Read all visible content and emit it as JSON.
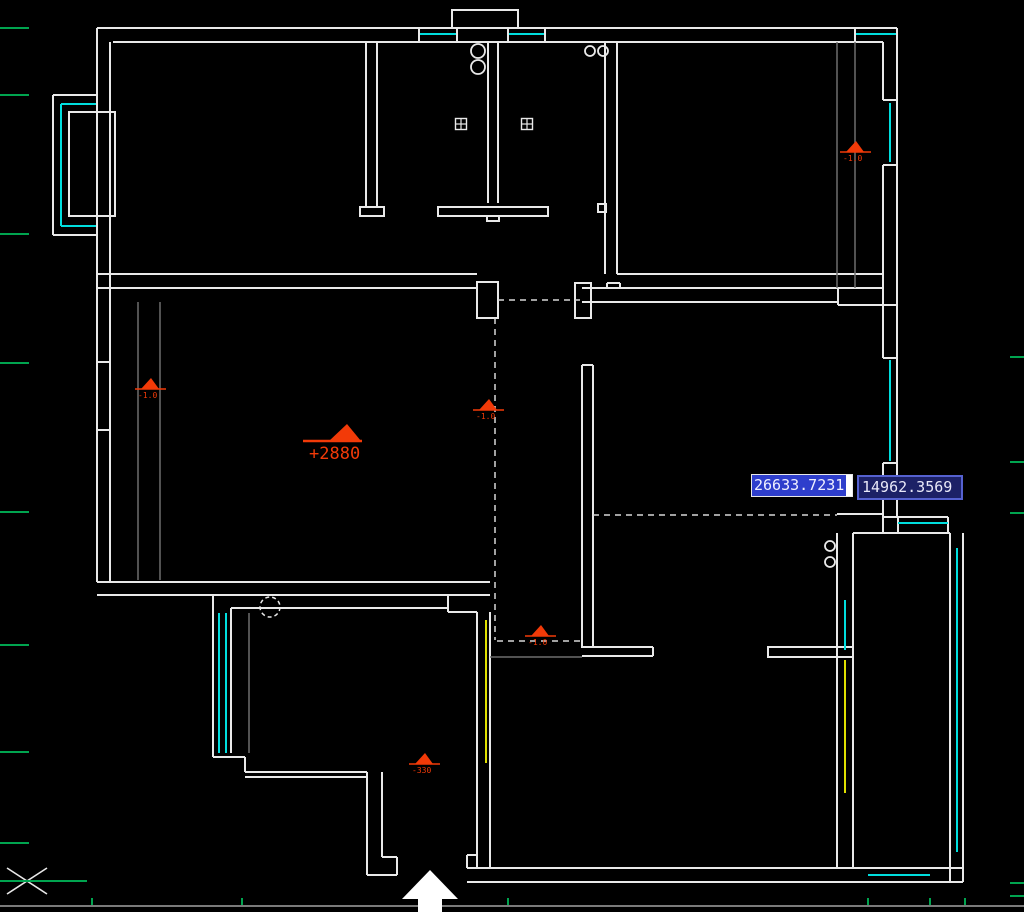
{
  "app": {
    "name": "cad-drawing-canvas",
    "background": "#000000",
    "edge_line_color": "#7a7a7a"
  },
  "dynamic_input": {
    "x_value": "26633.7231",
    "y_value": "14962.3569",
    "x_selected": true,
    "highlight_color": "#2e3ecc",
    "box2_bg": "#1c2166",
    "box2_border": "#5561d0"
  },
  "labels": {
    "main_elevation": "+2880"
  },
  "colors": {
    "wall": "#e9e9e9",
    "gray": "#6e6e6e",
    "window": "#00dede",
    "door": "#e0e000",
    "marker": "#f23a08",
    "green": "#00a44f",
    "dashed": "#d8d8d8",
    "arrow": "#ffffff"
  },
  "geometry": {
    "solid_lines": [
      [
        97,
        28,
        897,
        28
      ],
      [
        113,
        42,
        883,
        42
      ],
      [
        97,
        28,
        97,
        582
      ],
      [
        110,
        42,
        110,
        582
      ],
      [
        53,
        95,
        97,
        95
      ],
      [
        53,
        95,
        53,
        235
      ],
      [
        53,
        235,
        97,
        235
      ],
      [
        97,
        274,
        477,
        274
      ],
      [
        97,
        288,
        477,
        288
      ],
      [
        366,
        42,
        366,
        207
      ],
      [
        377,
        42,
        377,
        207
      ],
      [
        488,
        42,
        488,
        203
      ],
      [
        498,
        42,
        498,
        203
      ],
      [
        605,
        42,
        605,
        274
      ],
      [
        617,
        42,
        617,
        274
      ],
      [
        617,
        274,
        883,
        274
      ],
      [
        617,
        288,
        883,
        288
      ],
      [
        582,
        288,
        838,
        288
      ],
      [
        582,
        302,
        838,
        302
      ],
      [
        607,
        283,
        620,
        283
      ],
      [
        607,
        283,
        607,
        288
      ],
      [
        620,
        283,
        620,
        288
      ],
      [
        838,
        288,
        838,
        305
      ],
      [
        838,
        305,
        897,
        305
      ],
      [
        897,
        28,
        897,
        517
      ],
      [
        883,
        42,
        883,
        100
      ],
      [
        883,
        165,
        883,
        358
      ],
      [
        883,
        463,
        883,
        517
      ],
      [
        419,
        28,
        419,
        42
      ],
      [
        457,
        28,
        457,
        42
      ],
      [
        508,
        28,
        508,
        42
      ],
      [
        545,
        28,
        545,
        42
      ],
      [
        855,
        28,
        855,
        42
      ],
      [
        883,
        100,
        897,
        100
      ],
      [
        883,
        165,
        897,
        165
      ],
      [
        883,
        358,
        897,
        358
      ],
      [
        883,
        463,
        897,
        463
      ],
      [
        582,
        365,
        582,
        648
      ],
      [
        593,
        365,
        593,
        648
      ],
      [
        582,
        365,
        593,
        365
      ],
      [
        582,
        647,
        653,
        647
      ],
      [
        582,
        656,
        653,
        656
      ],
      [
        653,
        647,
        653,
        656
      ],
      [
        837,
        514,
        883,
        514
      ],
      [
        883,
        514,
        883,
        533
      ],
      [
        853,
        533,
        950,
        533
      ],
      [
        883,
        517,
        948,
        517
      ],
      [
        898,
        517,
        898,
        533
      ],
      [
        948,
        517,
        948,
        533
      ],
      [
        837,
        533,
        837,
        868
      ],
      [
        853,
        533,
        853,
        868
      ],
      [
        950,
        533,
        950,
        882
      ],
      [
        963,
        533,
        963,
        882
      ],
      [
        837,
        868,
        963,
        868
      ],
      [
        837,
        882,
        963,
        882
      ],
      [
        467,
        868,
        837,
        868
      ],
      [
        467,
        882,
        837,
        882
      ],
      [
        467,
        855,
        467,
        868
      ],
      [
        467,
        855,
        477,
        855
      ],
      [
        477,
        612,
        477,
        868
      ],
      [
        490,
        612,
        490,
        868
      ],
      [
        97,
        582,
        490,
        582
      ],
      [
        97,
        595,
        490,
        595
      ],
      [
        213,
        595,
        213,
        757
      ],
      [
        231,
        608,
        231,
        753
      ],
      [
        213,
        595,
        448,
        595
      ],
      [
        231,
        608,
        448,
        608
      ],
      [
        448,
        595,
        448,
        612
      ],
      [
        448,
        612,
        477,
        612
      ],
      [
        213,
        757,
        245,
        757
      ],
      [
        245,
        757,
        245,
        772
      ],
      [
        245,
        772,
        367,
        772
      ],
      [
        245,
        777,
        367,
        777
      ],
      [
        367,
        772,
        367,
        875
      ],
      [
        382,
        772,
        382,
        857
      ],
      [
        382,
        857,
        397,
        857
      ],
      [
        397,
        857,
        397,
        875
      ],
      [
        367,
        875,
        397,
        875
      ],
      [
        97,
        362,
        110,
        362
      ],
      [
        97,
        430,
        110,
        430
      ]
    ],
    "rects": [
      [
        69,
        112,
        46,
        104
      ],
      [
        477,
        282,
        21,
        36
      ],
      [
        575,
        283,
        16,
        35
      ],
      [
        438,
        207,
        110,
        9
      ],
      [
        487,
        216,
        12,
        5
      ],
      [
        360,
        207,
        24,
        9
      ],
      [
        598,
        204,
        8,
        8
      ],
      [
        768,
        647,
        85,
        10
      ],
      [
        452,
        10,
        66,
        18
      ]
    ],
    "gray_lines": [
      [
        138,
        302,
        138,
        580
      ],
      [
        160,
        302,
        160,
        580
      ],
      [
        837,
        42,
        837,
        288
      ],
      [
        855,
        42,
        855,
        288
      ],
      [
        249,
        613,
        249,
        753
      ],
      [
        490,
        657,
        582,
        657
      ]
    ],
    "cyan_lines": [
      [
        420,
        34,
        456,
        34
      ],
      [
        509,
        34,
        544,
        34
      ],
      [
        856,
        34,
        896,
        34
      ],
      [
        890,
        103,
        890,
        162
      ],
      [
        890,
        360,
        890,
        461
      ],
      [
        61,
        104,
        61,
        226
      ],
      [
        61,
        104,
        96,
        104
      ],
      [
        61,
        226,
        96,
        226
      ],
      [
        219,
        613,
        219,
        753
      ],
      [
        226,
        613,
        226,
        753
      ],
      [
        845,
        600,
        845,
        650
      ],
      [
        957,
        548,
        957,
        852
      ],
      [
        898,
        523,
        948,
        523
      ],
      [
        868,
        875,
        930,
        875
      ]
    ],
    "yellow_lines": [
      [
        486,
        620,
        486,
        763
      ],
      [
        845,
        660,
        845,
        793
      ]
    ],
    "dashed_lines": [
      [
        498,
        300,
        580,
        300
      ],
      [
        495,
        318,
        495,
        640
      ],
      [
        497,
        641,
        583,
        641
      ],
      [
        593,
        515,
        837,
        515
      ]
    ],
    "circles": [
      [
        478,
        51,
        7
      ],
      [
        478,
        67,
        7
      ],
      [
        590,
        51,
        5
      ],
      [
        603,
        51,
        5
      ],
      [
        830,
        546,
        5
      ],
      [
        830,
        562,
        5
      ]
    ],
    "dashed_circles": [
      [
        270,
        607,
        10
      ]
    ],
    "vents": [
      [
        461,
        124
      ],
      [
        527,
        124
      ]
    ],
    "marker_main": {
      "x": 345,
      "y": 441,
      "label": "+2880"
    },
    "markers_small": [
      {
        "x": 150,
        "y": 389,
        "label": "-1.0"
      },
      {
        "x": 488,
        "y": 410,
        "label": "-1.0"
      },
      {
        "x": 855,
        "y": 152,
        "label": "-1.0"
      },
      {
        "x": 540,
        "y": 636,
        "label": "-1.0"
      },
      {
        "x": 424,
        "y": 764,
        "label": "-330"
      }
    ],
    "green_ticks_left_y": [
      28,
      95,
      234,
      363,
      512,
      645,
      752,
      843
    ],
    "green_ticks_bottom_x": [
      92,
      242,
      508,
      868,
      930,
      965
    ],
    "green_ticks_right_y": [
      357,
      462,
      513,
      883,
      896
    ],
    "bottom_edge_line_y": 906,
    "north_arrow_points": "430,870 458,899 442,899 442,912 418,912 418,899 402,899",
    "ucs": {
      "cx": 27,
      "cy": 881,
      "arm": 20,
      "axis_x2": 87
    }
  }
}
